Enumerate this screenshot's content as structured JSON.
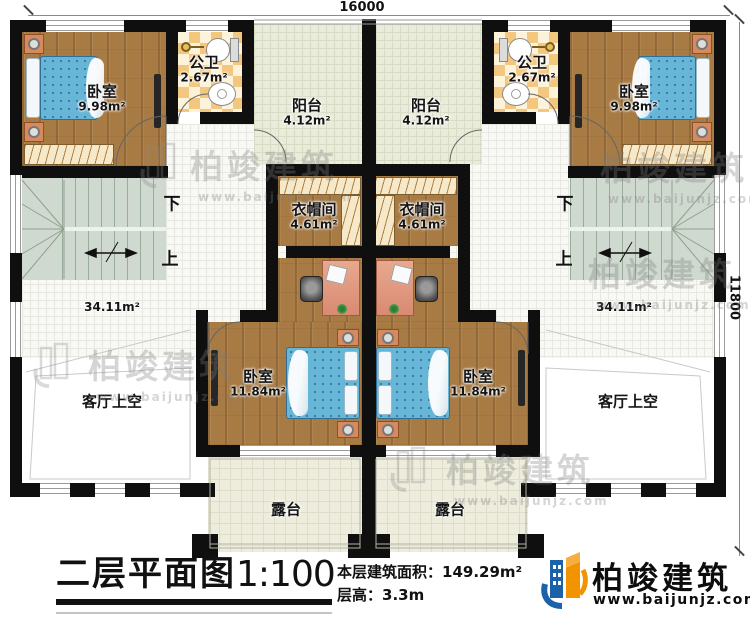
{
  "dimensions": {
    "width": "16000",
    "depth": "11800"
  },
  "rooms": {
    "bedroom_small": {
      "name": "卧室",
      "area": "9.98m²"
    },
    "bathroom": {
      "name": "公卫",
      "area": "2.67m²"
    },
    "balcony": {
      "name": "阳台",
      "area": "4.12m²"
    },
    "closet": {
      "name": "衣帽间",
      "area": "4.61m²"
    },
    "bedroom_large": {
      "name": "卧室",
      "area": "11.84m²"
    },
    "hall": {
      "area": "34.11m²"
    },
    "living_void": {
      "name": "客厅上空"
    },
    "terrace": {
      "name": "露台"
    }
  },
  "stairs": {
    "down": "下",
    "up": "上"
  },
  "title_block": {
    "title": "二层平面图",
    "scale": "1:100",
    "area_label": "本层建筑面积：",
    "area_value": "149.29m²",
    "height_label": "层高：",
    "height_value": "3.3m"
  },
  "logo": {
    "company": "柏竣建筑",
    "website": "www.baijunjz.com"
  },
  "watermark": {
    "company": "柏竣建筑",
    "website": "www.baijunjz.com"
  },
  "colors": {
    "wall": "#0f0f0f",
    "wood_floor": "#a87b44",
    "balcony_floor": "#eaecdb",
    "terrace_floor": "#eeeddd",
    "stair": "#cfd9cf",
    "checker_dark": "#f3c77e",
    "checker_light": "#fdf3da",
    "bed": "#67b6d7",
    "desk": "#d98a72",
    "logo_blue": "#1b62a8",
    "logo_orange": "#f29400"
  }
}
